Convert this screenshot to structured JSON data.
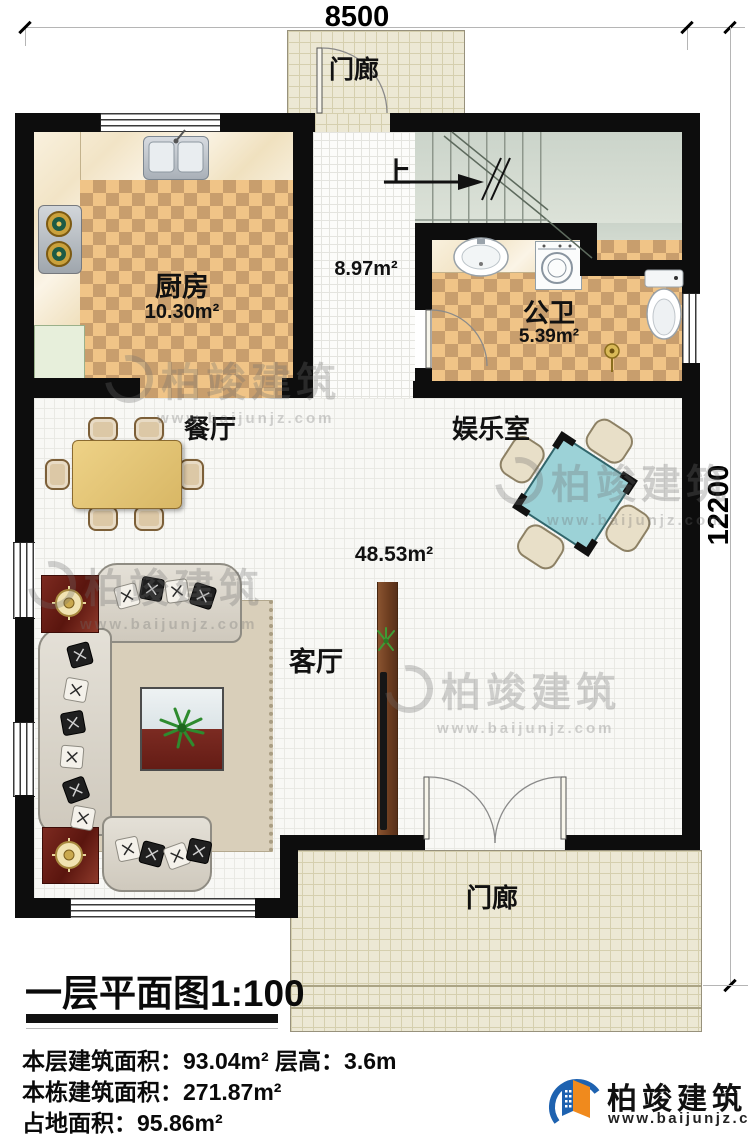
{
  "dimensions": {
    "width_label": "8500",
    "height_label": "12200"
  },
  "rooms": {
    "porch_top": {
      "label": "门廊"
    },
    "kitchen": {
      "label": "厨房",
      "area": "10.30m²"
    },
    "stair_hall": {
      "up_label": "上",
      "area": "8.97m²"
    },
    "bathroom": {
      "label": "公卫",
      "area": "5.39m²"
    },
    "dining": {
      "label": "餐厅"
    },
    "entertainment": {
      "label": "娱乐室"
    },
    "living": {
      "label": "客厅",
      "area": "48.53m²"
    },
    "porch_bottom": {
      "label": "门廊"
    }
  },
  "title": "一层平面图1:100",
  "info": {
    "lines": [
      "本层建筑面积：93.04m²  层高：3.6m",
      "本栋建筑面积：271.87m²",
      "占地面积：95.86m²"
    ]
  },
  "brand": {
    "name": "柏竣建筑",
    "url": "www.baijunjz.com"
  },
  "watermark": {
    "text": "柏竣建筑",
    "url": "www.baijunjz.com"
  },
  "colors": {
    "wall": "#0d0d0d",
    "checker_light": "#f0c487",
    "checker_dark": "#c89e6d",
    "porch_tile": "#ece8d4",
    "stair_floor": "#ccd5ca",
    "mahjong_table": "#9cd2d7",
    "brand_blue": "#1e62b0",
    "brand_orange": "#f08a1d"
  }
}
